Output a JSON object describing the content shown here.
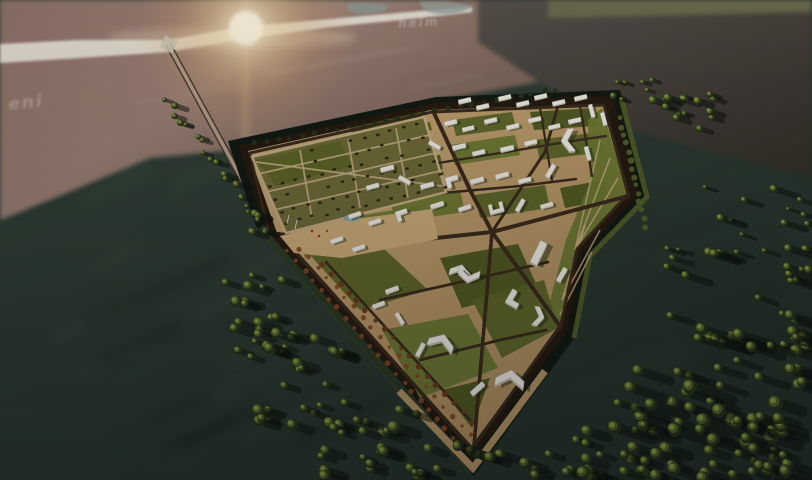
{
  "scene": {
    "title": "Aerial 3D masterplan visualization",
    "description": "High-altitude dusk render of a fortified shield-shaped new town on a wetland peninsula: white model buildings on tan plazas and olive lawns inside a dark star-fort rampart and moat, a suburban housing grid in the north-west lobe, an access highway crossing a sun-glared river at the horizon, dark teal marsh water on both flanks and dense round-canopy forest to the south-east.",
    "watermarks": {
      "left": "eni",
      "center": "heim"
    },
    "regions": {
      "new_town": "fortified masterplan district",
      "suburban_grid": "low-rise housing plots",
      "river": "sunlit river with bridge",
      "marsh_left": "dark wetland water",
      "marsh_right": "wetland with scattered trees",
      "forest_southeast": "dense forest",
      "highway": "access road to bridge"
    },
    "palette": {
      "water_dark": "#233129",
      "water_mid": "#2e3f36",
      "water_streak": "#4a5a4e",
      "terrain_mauve": "#967b71",
      "terrain_dark": "#6b574e",
      "terrain_light": "#b1998c",
      "mudflat": "#4a453c",
      "mudflat_dark": "#35322b",
      "olive_strip": "#6d6e4e",
      "river": "#e9e5da",
      "inlet": "#8d9894",
      "sun_core": "#fdf7e6",
      "sun_warm": "#edc98f",
      "site_tan": "#c2a06f",
      "site_tan_light": "#d2b285",
      "site_tan_dark": "#aa8e5f",
      "lawn": "#5c6628",
      "lawn_dark": "#4c5820",
      "lawn_light": "#6d7a33",
      "road": "#3a2b1d",
      "road_light": "#c8b188",
      "rampart": "#241a10",
      "canal": "#101a13",
      "canal_green": "#3a4c2f",
      "building": "#f3f1ea",
      "building_side": "#c7c1b2",
      "building_shadow": "#1f2a14",
      "tree_dark": "#26321b",
      "tree_mid": "#4f6129",
      "tree_light": "#869b42",
      "tree_autumn": "#7c4421",
      "house": "#2e2517",
      "shadow": "#0b120d",
      "pond": "#7fa8b3",
      "accent_red": "#a33a28"
    }
  }
}
